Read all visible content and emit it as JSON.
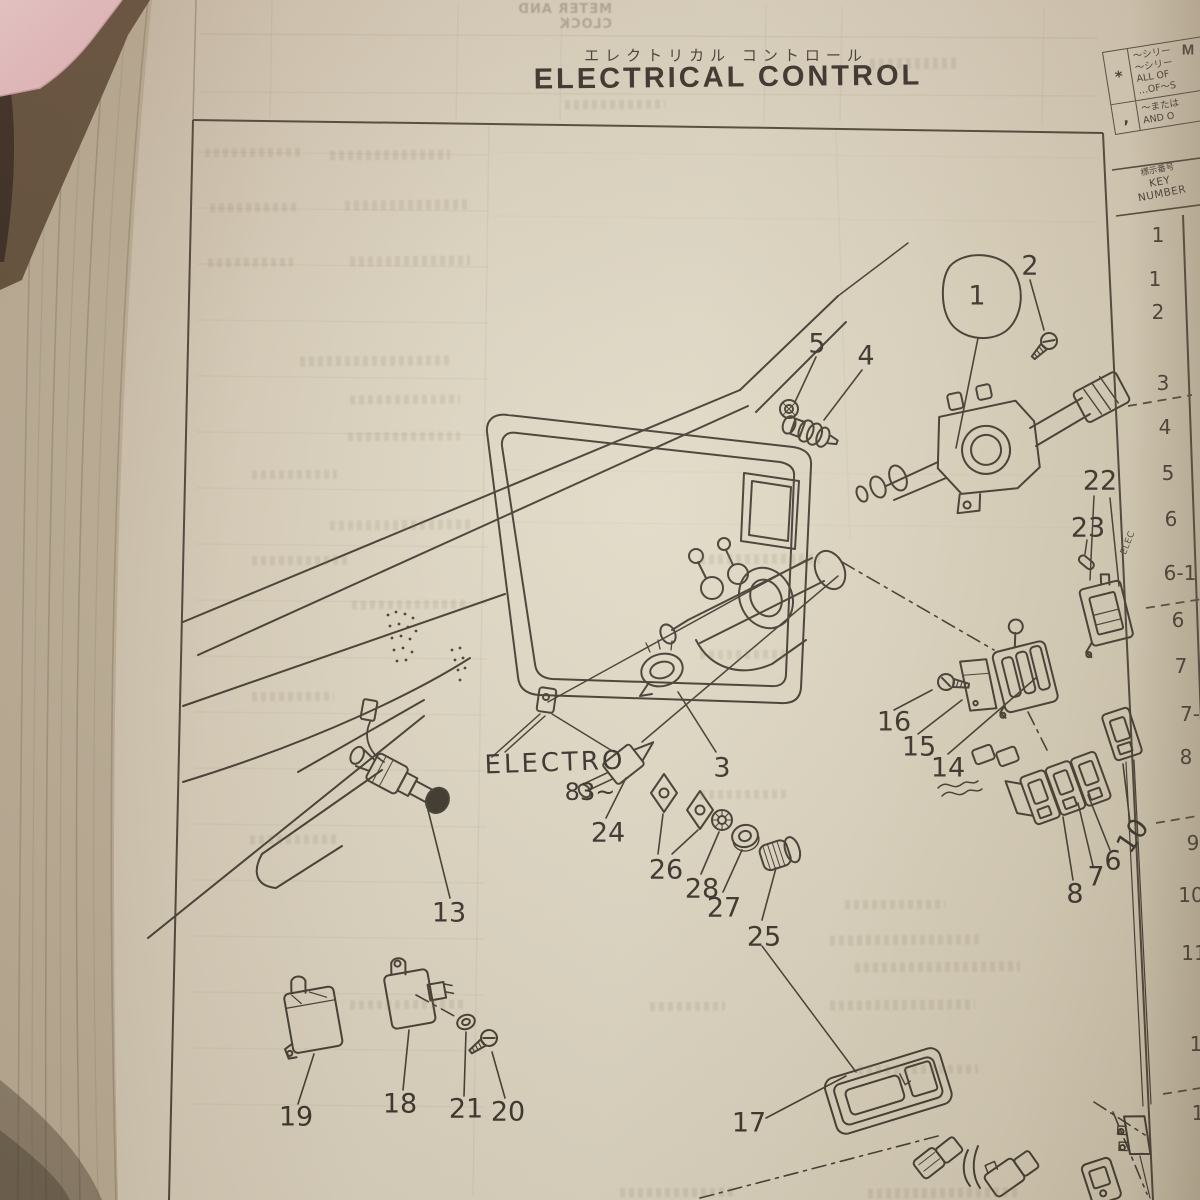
{
  "page": {
    "title_jp": "エレクトリカル コントロール",
    "title_en": "ELECTRICAL CONTROL",
    "bleedthrough_text": "METER AND CLOCK",
    "corner_letter": "M"
  },
  "colors": {
    "paper": "#d8cfc0",
    "ink": "#3c352b",
    "sticky_note_pink": "#f2c6cc"
  },
  "legend": {
    "rows": [
      {
        "symbol": "*",
        "line1": "〜シリー",
        "line2": "〜シリー",
        "line3": "ALL OF",
        "line4": "…OF〜S"
      },
      {
        "symbol": ",",
        "line1": "〜または",
        "line2": "AND O",
        "line3": "",
        "line4": ""
      }
    ],
    "key_header_jp": "標示番号",
    "key_header_en1": "KEY",
    "key_header_en2": "NUMBER"
  },
  "key_column": [
    "1",
    "1",
    "2",
    "3",
    "4",
    "5",
    "6",
    "6-1",
    "6",
    "7",
    "7-",
    "8",
    "9",
    "10",
    "11",
    "1",
    "1"
  ],
  "diagram": {
    "electro_label": "ELECTRO",
    "electro_sub": "83~",
    "unit_text": "ELEC",
    "callouts": [
      "1",
      "2",
      "3",
      "4",
      "5",
      "6",
      "7",
      "8",
      "10",
      "13",
      "14",
      "15",
      "16",
      "17",
      "18",
      "19",
      "20",
      "21",
      "22",
      "23",
      "24",
      "25",
      "26",
      "27",
      "28"
    ]
  }
}
